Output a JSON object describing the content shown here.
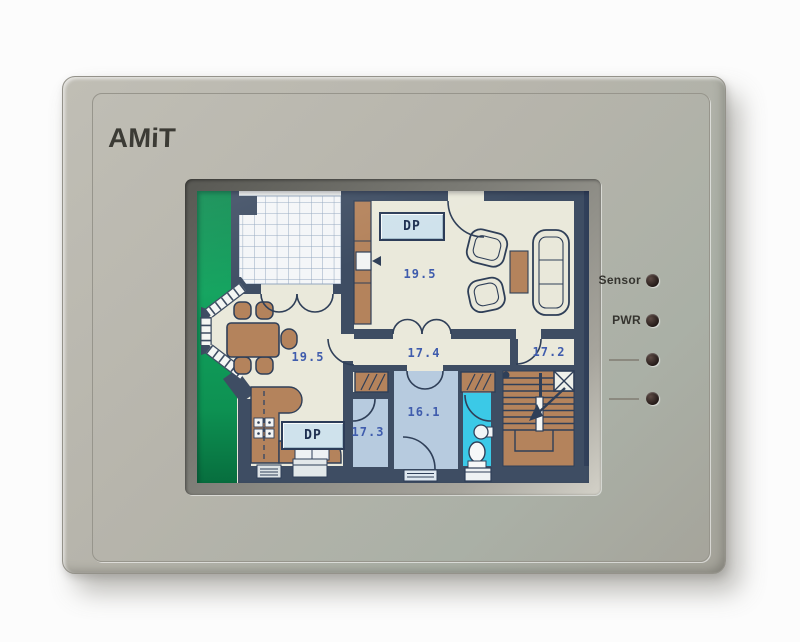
{
  "device": {
    "brand_logo": "AMiT",
    "indicator_labels": {
      "sensor": "Sensor",
      "power": "PWR"
    }
  },
  "screen": {
    "dp_button_top": "DP",
    "dp_button_bottom": "DP",
    "rooms": {
      "living": {
        "temp": "19.5"
      },
      "dining": {
        "temp": "19.5"
      },
      "hall": {
        "temp": "17.4"
      },
      "guest": {
        "temp": "17.2"
      },
      "study": {
        "temp": "17.3"
      },
      "bath": {
        "temp": "16.1"
      }
    }
  },
  "colors": {
    "wall": "#3e4d63",
    "floor": "#eae9db",
    "garden_green": "#12a35e",
    "room_blue": "#b7cbdf",
    "toilet_cyan": "#3bc9e7",
    "furniture_brown": "#b4835c",
    "temp_text": "#3f5cad",
    "bezel": "#b6b4ab"
  }
}
